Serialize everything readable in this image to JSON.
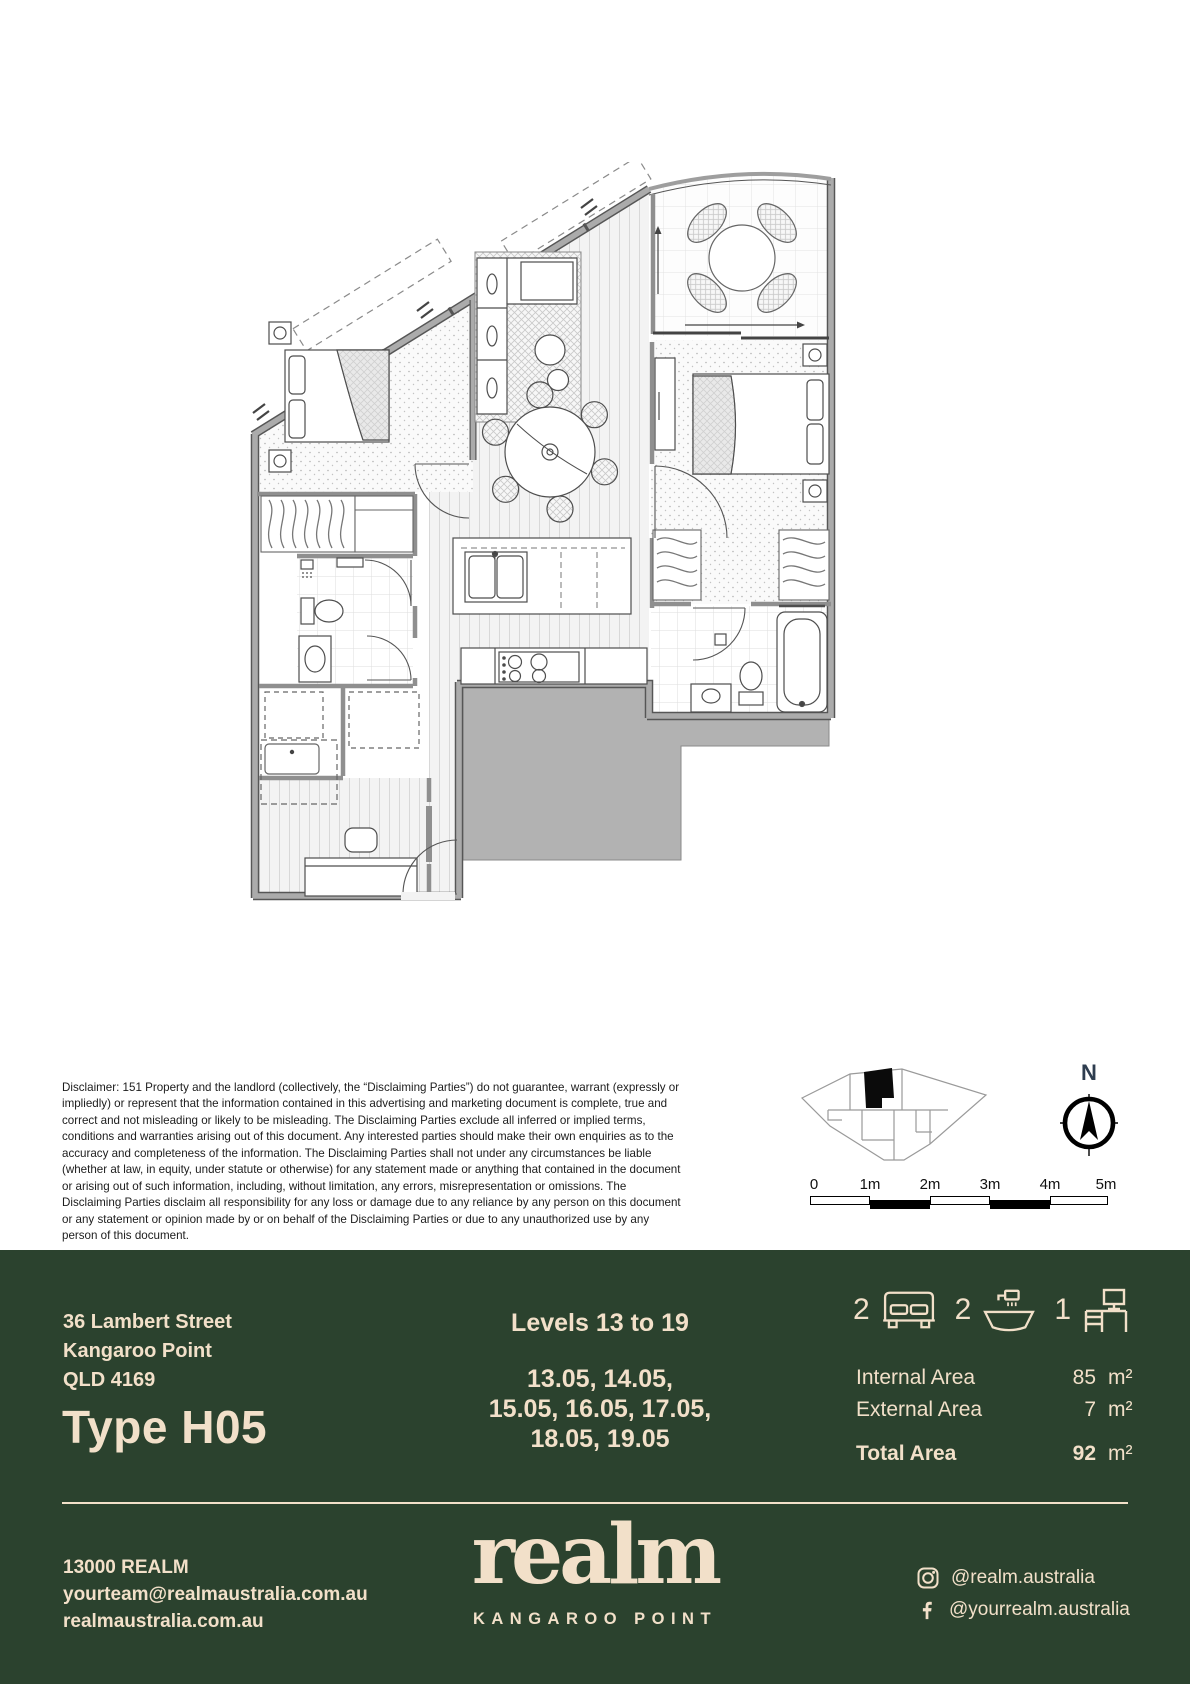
{
  "colors": {
    "footer_green": "#2b422e",
    "cream": "#f2e0c9",
    "north_navy": "#2e3d4f"
  },
  "disclaimer": "Disclaimer: 151 Property and the landlord (collectively, the “Disclaiming Parties”) do not guarantee, warrant (expressly or impliedly) or represent that the information contained in this advertising and marketing document is complete, true and correct and not misleading or likely to be misleading. The Disclaiming Parties exclude all inferred or implied terms, conditions and warranties arising out of this document. Any interested parties should make their own enquiries as to the accuracy and completeness of the information. The Disclaiming Parties shall not under any circumstances be liable (whether at law, in equity, under statute or otherwise) for any statement made or anything that contained in the document or arising out of such information, including, without limitation, any errors, misrepresentation or omissions. The Disclaiming Parties disclaim all responsibility for any loss or damage due to any reliance by any person on this document or any statement or opinion made by or on behalf of the Disclaiming Parties or due to any unauthorized use by any person of this document.",
  "north": {
    "label": "N"
  },
  "scale_bar": {
    "labels": [
      "0",
      "1m",
      "2m",
      "3m",
      "4m",
      "5m"
    ]
  },
  "listing": {
    "address_line1": "36 Lambert Street",
    "address_line2": "Kangaroo Point",
    "address_line3": "QLD 4169",
    "type_title": "Type H05",
    "levels_title": "Levels 13 to 19",
    "units_line1": "13.05, 14.05,",
    "units_line2": "15.05, 16.05, 17.05,",
    "units_line3": "18.05, 19.05",
    "features": [
      {
        "name": "bedrooms",
        "count": "2"
      },
      {
        "name": "bathrooms",
        "count": "2"
      },
      {
        "name": "study",
        "count": "1"
      }
    ],
    "areas": [
      {
        "label": "Internal Area",
        "value": "85",
        "unit": "m²"
      },
      {
        "label": "External Area",
        "value": "7",
        "unit": "m²"
      },
      {
        "label": "Total Area",
        "value": "92",
        "unit": "m²"
      }
    ]
  },
  "contact": {
    "phone": "13000 REALM",
    "email": "yourteam@realmaustralia.com.au",
    "website": "realmaustralia.com.au"
  },
  "brand": {
    "logo_text": "realm",
    "location": "KANGAROO POINT"
  },
  "social": [
    {
      "network": "instagram",
      "handle": "@realm.australia"
    },
    {
      "network": "facebook",
      "handle": "@yourrealm.australia"
    }
  ]
}
